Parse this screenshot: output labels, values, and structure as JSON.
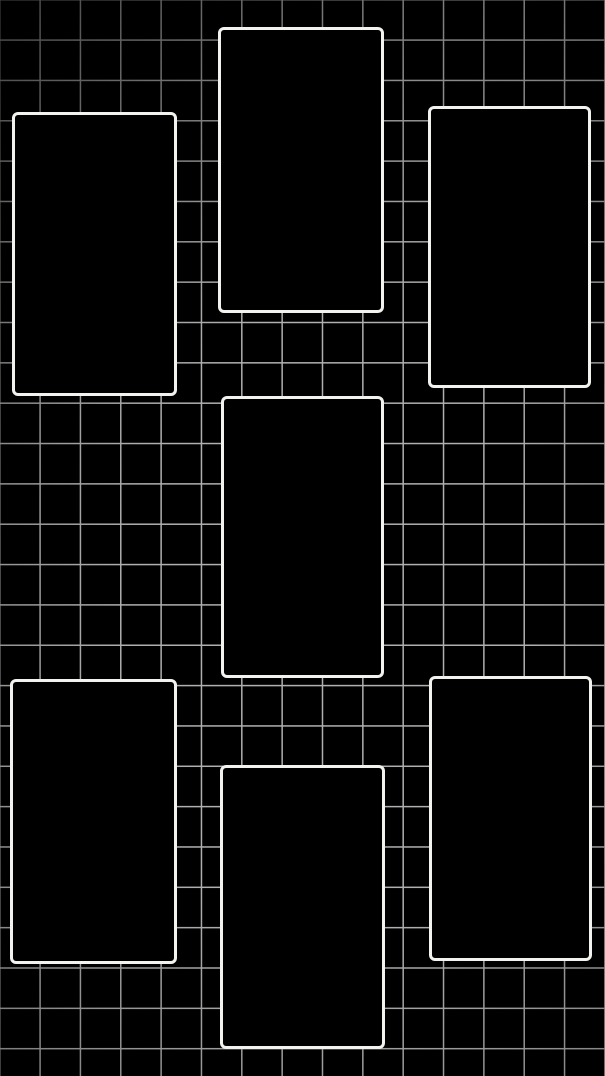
{
  "screen": {
    "width_px": 605,
    "height_px": 1076,
    "description": "Dark wallpaper-style collage: black background, square grid pattern with vignette, seven empty portrait frames in three staggered columns"
  },
  "colors": {
    "background": "#000000",
    "grid_line": "#b0b0b0",
    "frame_border": "#f2f2ee",
    "frame_fill": "#000000"
  },
  "grid": {
    "cell_size_px": 40.35,
    "line_thickness_px": 1.5,
    "vignette": "grid lines fade darker toward edges, dimmest at top-left corner"
  },
  "frames": [
    {
      "name": "photo-frame-top-left",
      "x": 12,
      "y": 112,
      "width": 165,
      "height": 284
    },
    {
      "name": "photo-frame-top-center",
      "x": 218,
      "y": 27,
      "width": 166,
      "height": 286
    },
    {
      "name": "photo-frame-top-right",
      "x": 428,
      "y": 106,
      "width": 163,
      "height": 282
    },
    {
      "name": "photo-frame-middle-center",
      "x": 221,
      "y": 396,
      "width": 163,
      "height": 282
    },
    {
      "name": "photo-frame-bottom-left",
      "x": 10,
      "y": 679,
      "width": 167,
      "height": 285
    },
    {
      "name": "photo-frame-bottom-center",
      "x": 220,
      "y": 765,
      "width": 165,
      "height": 284
    },
    {
      "name": "photo-frame-bottom-right",
      "x": 429,
      "y": 676,
      "width": 163,
      "height": 285
    }
  ]
}
